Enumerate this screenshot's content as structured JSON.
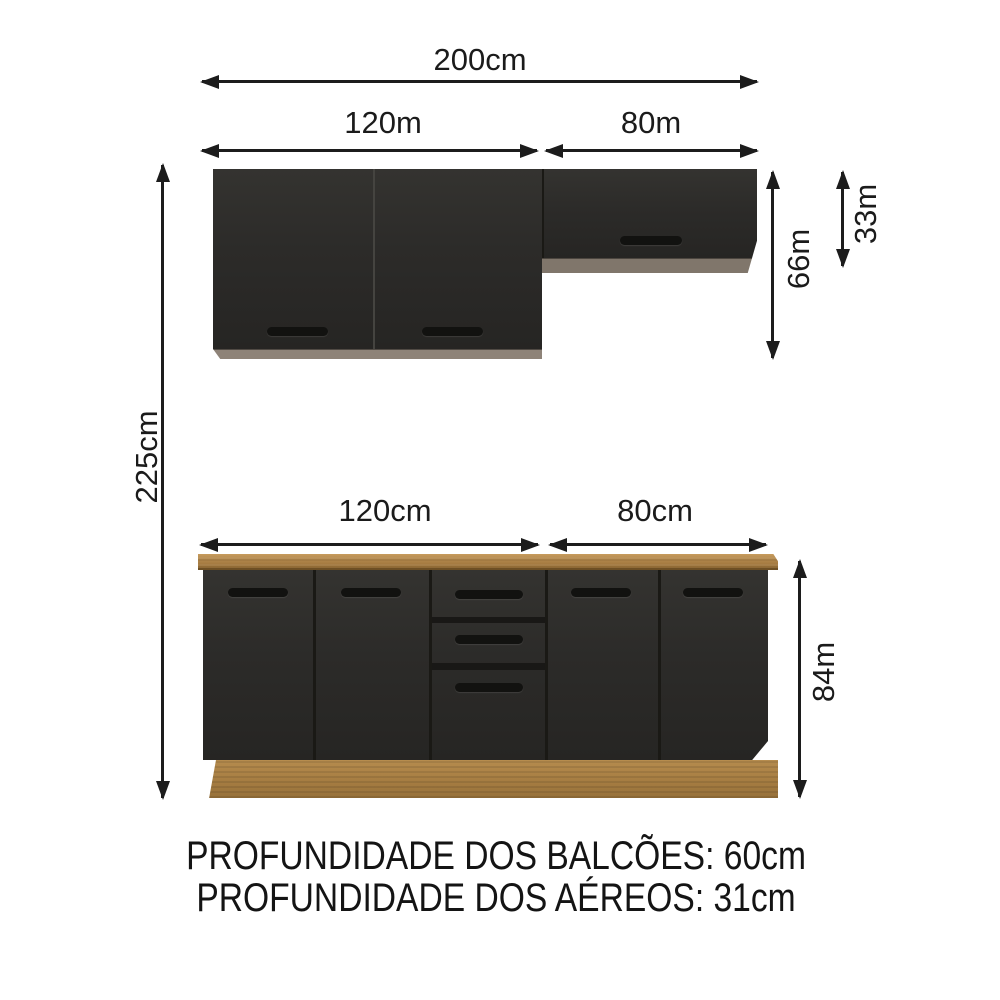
{
  "diagram_title": "kitchen-cabinet-set-dimension-diagram",
  "dimensions": {
    "overall_width": "200cm",
    "upper_left_width": "120m",
    "upper_right_width": "80m",
    "counter_left_width": "120cm",
    "counter_right_width": "80cm",
    "overall_height": "225cm",
    "upper_cabinet_height": "66m",
    "upper_right_cabinet_height": "33m",
    "counter_height": "84m"
  },
  "footer": {
    "line1": "PROFUNDIDADE DOS BALCÕES: 60cm",
    "line2": "PROFUNDIDADE DOS AÉREOS: 31cm"
  },
  "colors": {
    "cabinet_front": "#2c2b29",
    "handle": "#121210",
    "upper_trim": "#8e8378",
    "wood": "#b68c50",
    "ink": "#1c1c1c",
    "background": "#ffffff"
  }
}
